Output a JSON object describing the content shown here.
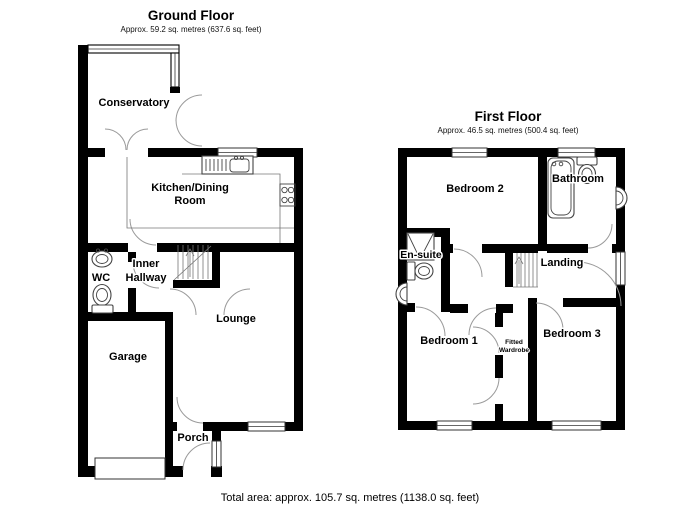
{
  "ground_floor": {
    "title": "Ground Floor",
    "subtitle": "Approx. 59.2 sq. metres (637.6 sq. feet)",
    "labels": {
      "conservatory": "Conservatory",
      "kitchen_line1": "Kitchen/Dining",
      "kitchen_line2": "Room",
      "wc": "WC",
      "inner_line1": "Inner",
      "inner_line2": "Hallway",
      "lounge": "Lounge",
      "garage": "Garage",
      "porch": "Porch"
    }
  },
  "first_floor": {
    "title": "First Floor",
    "subtitle": "Approx. 46.5 sq. metres (500.4 sq. feet)",
    "labels": {
      "bedroom2": "Bedroom 2",
      "bathroom": "Bathroom",
      "ensuite": "En-suite",
      "landing": "Landing",
      "bedroom1": "Bedroom 1",
      "bedroom3": "Bedroom 3",
      "wardrobe_line1": "Fitted",
      "wardrobe_line2": "Wardrobe"
    }
  },
  "footer": {
    "total_area": "Total area: approx. 105.7 sq. metres (1138.0 sq. feet)"
  },
  "colors": {
    "wall": "#000000",
    "background": "#ffffff",
    "door_arc": "#9a9a9a",
    "fixture_line": "#444444"
  }
}
